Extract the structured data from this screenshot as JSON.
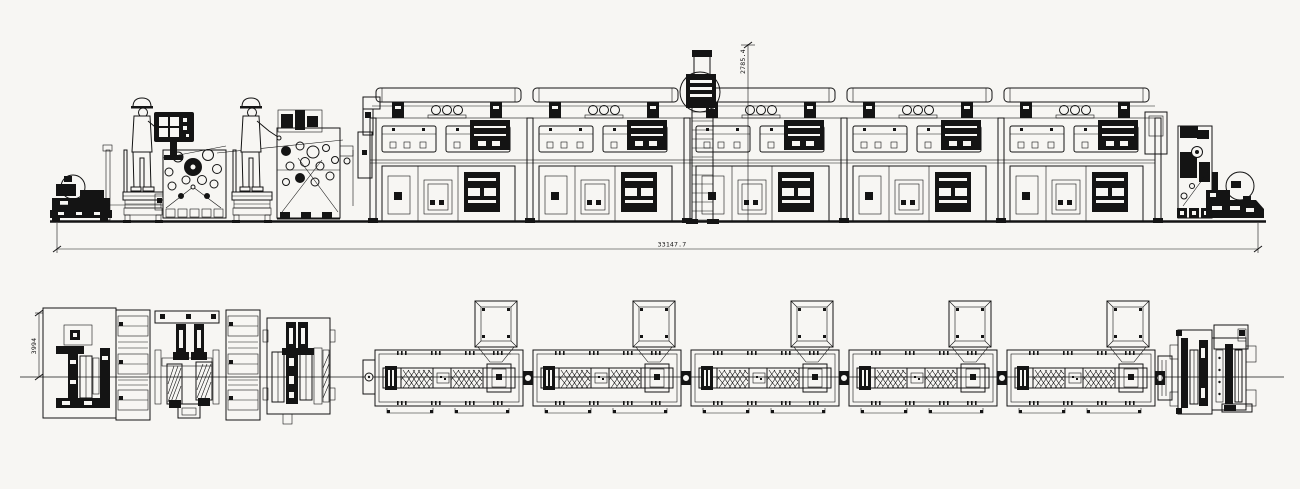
{
  "canvas": {
    "width": 1300,
    "height": 489,
    "background": "#f7f6f3",
    "ink": "#141414"
  },
  "dimensions": {
    "total_length": "33147.7",
    "stack_height": "2785.4",
    "line_width": "3994"
  },
  "counts": {
    "dryer_modules": 5,
    "exhaust_hoods": 5,
    "operators": 2
  }
}
